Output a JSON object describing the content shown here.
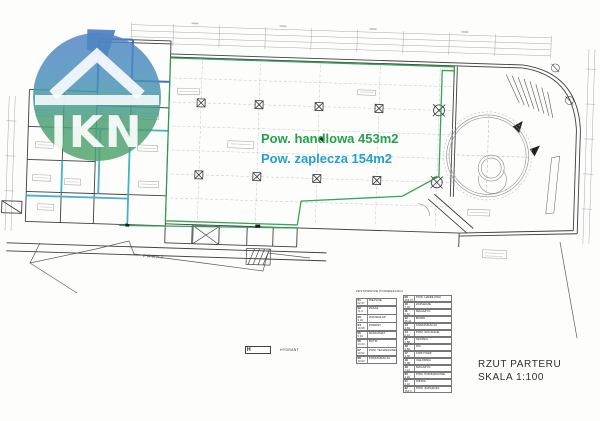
{
  "logo": {
    "text": "JKN"
  },
  "annotations": {
    "area_retail": "Pow. handlowa 453m2",
    "area_back": "Pow. zaplecza 154m2"
  },
  "plan_labels": {
    "pasaz": "PASAŻ",
    "hydrant_symbol": "H",
    "hydrant": "HYDRANT"
  },
  "title_block": {
    "title": "RZUT PARTERU",
    "scale": "SKALA 1:100"
  },
  "legend": {
    "header": "ZESTAWIENIE POWIERZCHNI",
    "left": [
      {
        "num": "01",
        "label": "WEJŚCIE",
        "area": "62,37"
      },
      {
        "num": "02",
        "label": "PASAŻ",
        "area": "71,0"
      },
      {
        "num": "03",
        "label": "WIATROŁAP",
        "area": "3,04"
      },
      {
        "num": "04",
        "label": "PODEST",
        "area": "19,98"
      },
      {
        "num": "05",
        "label": "BANKOMAT",
        "area": "5,19"
      },
      {
        "num": "06",
        "label": "BUTIK",
        "area": "24,34"
      },
      {
        "num": "07",
        "label": "POM. TECHNICZNE",
        "area": "10,52"
      },
      {
        "num": "08",
        "label": "KOMUNIKACJA",
        "area": "19,93"
      }
    ],
    "right": [
      {
        "num": "09",
        "label": "POW. HANDLOWA",
        "area": "453,07"
      },
      {
        "num": "10",
        "label": "ZAPLECZE",
        "area": "7,46"
      },
      {
        "num": "11",
        "label": "MAGAZYN",
        "area": "6,62"
      },
      {
        "num": "12",
        "label": "BIURO",
        "area": "25,41"
      },
      {
        "num": "13",
        "label": "KOMUNIKACJA",
        "area": "3,84"
      },
      {
        "num": "14",
        "label": "POM. SOCJALNE",
        "area": "6,41"
      },
      {
        "num": "15",
        "label": "SZATNIA",
        "area": "2,88"
      },
      {
        "num": "16",
        "label": "WC",
        "area": "4,59"
      },
      {
        "num": "17",
        "label": "KORYTARZ",
        "area": "3,66"
      },
      {
        "num": "18",
        "label": "CHŁODNIA",
        "area": "5,98"
      },
      {
        "num": "19",
        "label": "MAGAZYN",
        "area": "7,14"
      },
      {
        "num": "20",
        "label": "POM. PORZĄDKOWE",
        "area": "4,46"
      },
      {
        "num": "21",
        "label": "WINDA",
        "area": "2,10"
      },
      {
        "num": "22",
        "label": "POW. ZAPLECZA",
        "area": "154,0"
      }
    ]
  },
  "colors": {
    "accent_green": "#22a24d",
    "accent_teal": "#21a0d2",
    "boundary_green": "#2f9e52",
    "wall_teal": "#43b2cb",
    "wall_blue": "#3e74bd",
    "line_dark": "#3f3f42",
    "line_light": "#a8a8ad"
  }
}
